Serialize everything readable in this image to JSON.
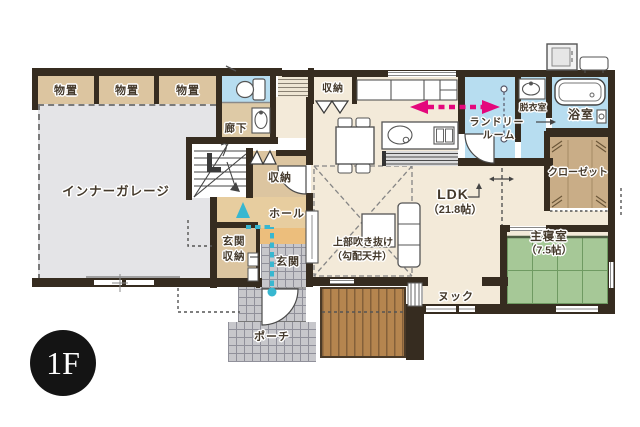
{
  "floor_badge": "1F",
  "rooms": {
    "storage_rooms": [
      "物置",
      "物置",
      "物置"
    ],
    "corridor": "廊下",
    "garage": "インナーガレージ",
    "stair_closet": "収納",
    "kitchen_closet": "収納",
    "laundry_line1": "ランドリー",
    "laundry_line2": "ルーム",
    "dressing": "脱衣室",
    "bath": "浴室",
    "closet": "クローゼット",
    "ldk_line1": "LDK",
    "ldk_line2": "（21.8帖）",
    "hall": "ホール",
    "entrance_storage_line1": "玄関",
    "entrance_storage_line2": "収納",
    "entrance": "玄関",
    "void_line1": "上部吹き抜け",
    "void_line2": "（勾配天井）",
    "nook": "ヌック",
    "bedroom_line1": "主寝室",
    "bedroom_line2": "（7.5帖）",
    "porch": "ポーチ"
  },
  "icons": {
    "toilet": "toilet-icon",
    "washbasin_corridor": "washbasin-icon",
    "washbasin_dressing": "washbasin-icon",
    "bathtub": "bathtub-icon",
    "water_heater": "water-heater-icon",
    "heat_pump": "heat-pump-icon",
    "kitchen_island": "kitchen-island-icon",
    "cupboard": "cupboard-icon",
    "dining_table": "dining-table-icon",
    "sofa": "sofa-icon",
    "tv_board": "tv-board-icon",
    "stairs": "stairs-icon",
    "laundry_pole": "laundry-pole-icon",
    "flow_arrow": "pink-flow-arrow",
    "entry_arrow": "teal-entry-arrow"
  },
  "colors": {
    "wall": "#362c20",
    "tan_room": "#dcc5a0",
    "cream_room": "#f3ead9",
    "water_room": "#b7ddf0",
    "garage_gray": "#e4e4e7",
    "tile_gray": "#c7c7cb",
    "tatami_green": "#a6c897",
    "wood_deck": "#b5854f",
    "closet_brown": "#c9ad87",
    "hall_orange": "#e7cd9f",
    "step_orange": "#ecbe7c",
    "accent_pink": "#e4077c",
    "accent_teal": "#38b7d0"
  }
}
